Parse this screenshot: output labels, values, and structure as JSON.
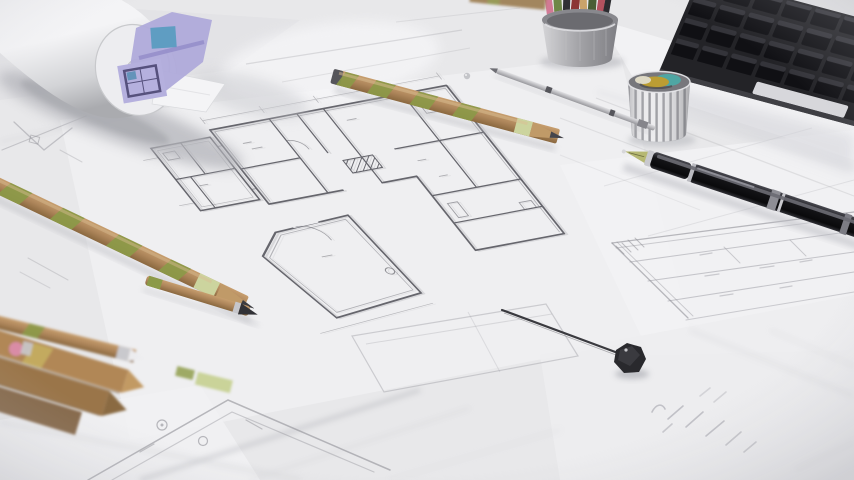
{
  "scene": {
    "type": "photo",
    "subject": "Architectural blueprint floor plans spread on a desk with drafting tools",
    "objects": [
      "rolled-blueprint",
      "lavender-plan-sheet",
      "floor-plan-drawing",
      "striped-pencil-on-plan",
      "striped-pencil-left",
      "pencil-pile",
      "pink-eraser",
      "wooden-pen",
      "colored-pencil-cup",
      "washi-tape-cup",
      "black-keyboard",
      "fountain-pen",
      "drafting-lead-holder",
      "drafting-divider",
      "title-block-table",
      "handwriting-notes",
      "detail-plan-fragment",
      "water-droplet"
    ]
  },
  "palette": {
    "bg": "#e8e8ea",
    "sheet-white": "#f3f3f5",
    "sheet-light": "#efeff1",
    "ink": "#4e4e56",
    "ink-faint": "#9a9aa1",
    "roll-light": "#f4f4f6",
    "roll-mid": "#d3d4d7",
    "roll-dark": "#aaabaf",
    "lavender": "#b0abdb",
    "lavender-frame": "#56517d",
    "blueprint-blue": "#5f9dc2",
    "wood": "#ad855a",
    "wood-dark": "#8a683f",
    "olive": "#8c9a48",
    "olive-light": "#ccd49e",
    "graphite": "#45454b",
    "pen-black": "#141417",
    "pen-silver": "#c7c7cc",
    "nib-gold": "#b6b873",
    "keyboard-body": "#232327",
    "key-face": "#101014",
    "key-top": "#3b3b41",
    "metal-light": "#d4d4d7",
    "metal-mid": "#a2a2a6",
    "metal-dark": "#7e7e83",
    "tape-teal": "#4fa6a3",
    "tape-gold": "#bb9d33",
    "tape-cream": "#ded9c5",
    "eraser-pink": "#d98ca6",
    "shadow": "#b9bac1"
  }
}
